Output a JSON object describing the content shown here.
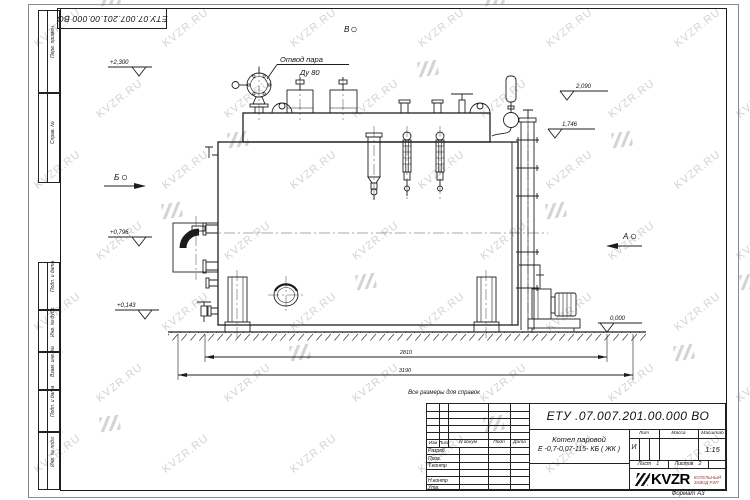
{
  "sheet": {
    "watermark_text": "KVZR.RU",
    "stamp_doc_number": "ЕТУ.07.007.201.00.000  ВО",
    "format_label": "Формат А3",
    "reference_note": "Все размеры для справок"
  },
  "frame_columns": [
    "Перв. примен.",
    "Справ. №",
    "Подп. и дата",
    "Инв. № дубл.",
    "Взам. инв. №",
    "Подп. и дата",
    "Инв. № подл."
  ],
  "drawing": {
    "view_a": "А",
    "view_b": "Б",
    "view_v": "В",
    "steam_outlet_label": "Отвод пара",
    "steam_outlet_dn": "Ду 80",
    "elev_top": "+2,300",
    "elev_2090": "2,090",
    "elev_1746": "1,746",
    "elev_0796": "+0,796",
    "elev_0143": "+0,143",
    "elev_zero": "0,000",
    "dim_inner": "2810",
    "dim_overall": "3190"
  },
  "title_block": {
    "doc_number": "ЕТУ .07.007.201.00.000  ВО",
    "product_name_line1": "Котел паровой",
    "product_name_line2": "Е -0,7-0,07-115- КБ ( ЖК )",
    "col_izm": "Изм",
    "col_list": "Лист",
    "col_ndoc": "N докум",
    "col_podp": "Подп",
    "col_data": "Дата",
    "rows": [
      "Разраб.",
      "Пров.",
      "Т.контр",
      "",
      "Н.контр",
      "Утв."
    ],
    "lit_label": "Лит",
    "mass_label": "Масса",
    "scale_label": "Масштаб",
    "lit_value": "И",
    "scale_value": "1:15",
    "sheet_label": "Лист",
    "sheet_value": "1",
    "sheets_label": "Листов",
    "sheets_value": "2",
    "logo_text": "KVZR",
    "logo_sub1": "КОТЕЛЬНЫЙ",
    "logo_sub2": "ЗАВОД РЭП"
  }
}
